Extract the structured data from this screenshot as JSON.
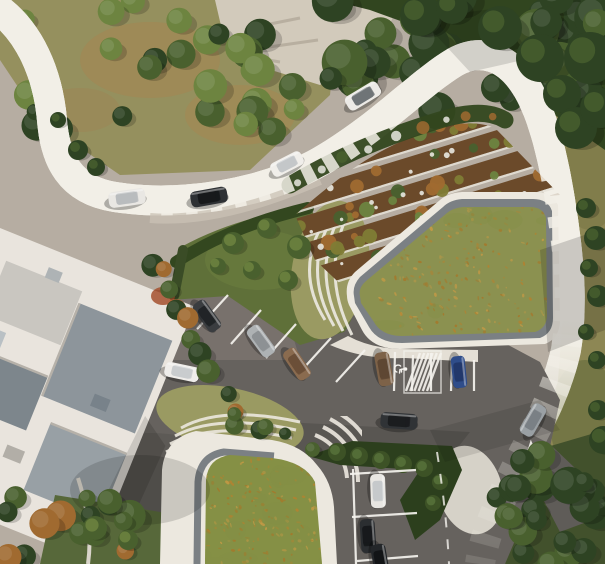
{
  "scene": {
    "description": "Aerial architectural rendering: two green-roof buildings with planted terraces, curving access road with cars, central parking lot",
    "palette": {
      "base": "#b6ada2",
      "road_light": "#a9a199",
      "road_mid": "#978f88",
      "road_dark": "#6b6864",
      "road_edge": "#f2efe7",
      "asphalt": "#66625e",
      "asphalt_light": "#8d867f",
      "asphalt_shadow": "#55524e",
      "line_white": "#f5f3ee",
      "veg_ground": "#95905e",
      "dirt_patch": "#a8844f",
      "rock": "#d2cabb",
      "grass_right": "#8d8754",
      "lawn": "#5f7039",
      "lawn_dark": "#4c5c2f",
      "tree_dark": "#2e4323",
      "tree_mid": "#49602e",
      "tree_light": "#6d8440",
      "tree_olive": "#7f7c35",
      "tree_orange": "#a06a30",
      "roof_green": "#8b9150",
      "roof_green2": "#859045",
      "speckle1": "#b5812f",
      "speckle2": "#c79a45",
      "speckle3": "#a87628",
      "gravel": "#7b8084",
      "rim": "#ece8df",
      "rim_shadow": "#cfc9bd",
      "slab_bed": "#9a9a62",
      "bldg_white": "#e9e4dd",
      "bldg_shade": "#d8d2c8",
      "slate": "#8d959b",
      "slate_dark": "#6d767b",
      "soil": "#6b4a2a",
      "blossom": "#e9e8e0",
      "hedge": "#33471f",
      "paving": "#d6d2c8"
    },
    "cars": [
      {
        "name": "car-road-white-1",
        "x": 127,
        "y": 198,
        "a": -8,
        "len": 37,
        "wid": 16,
        "body": "#e9e7e3",
        "roof": "#b9bcbe"
      },
      {
        "name": "car-road-dark",
        "x": 209,
        "y": 197,
        "a": -10,
        "len": 37,
        "wid": 16,
        "body": "#2e3134",
        "roof": "#17191b"
      },
      {
        "name": "car-road-white-2",
        "x": 287,
        "y": 164,
        "a": -27,
        "len": 34,
        "wid": 15,
        "body": "#f0eeea",
        "roof": "#c4c7c9"
      },
      {
        "name": "car-road-white-3",
        "x": 363,
        "y": 96,
        "a": -31,
        "len": 37,
        "wid": 16,
        "body": "#eceae6",
        "roof": "#6f7477"
      },
      {
        "name": "car-parked-dark-1",
        "x": 207,
        "y": 316,
        "a": 54,
        "len": 34,
        "wid": 15,
        "body": "#3a3d40",
        "roof": "#212427"
      },
      {
        "name": "car-parked-silver",
        "x": 261,
        "y": 341,
        "a": 54,
        "len": 34,
        "wid": 15,
        "body": "#aeb2b4",
        "roof": "#8d9194"
      },
      {
        "name": "car-parked-brown-1",
        "x": 297,
        "y": 364,
        "a": 56,
        "len": 34,
        "wid": 15,
        "body": "#8a6b4f",
        "roof": "#6b4f38"
      },
      {
        "name": "car-parked-brown-2",
        "x": 384,
        "y": 369,
        "a": 80,
        "len": 34,
        "wid": 15,
        "body": "#7d6248",
        "roof": "#5e4733"
      },
      {
        "name": "car-parked-blue",
        "x": 459,
        "y": 372,
        "a": 84,
        "len": 32,
        "wid": 14,
        "body": "#2f4d8a",
        "roof": "#22386b"
      },
      {
        "name": "car-lot-white-moving",
        "x": 182,
        "y": 372,
        "a": 12,
        "len": 35,
        "wid": 15,
        "body": "#efedea",
        "roof": "#c9ccce"
      },
      {
        "name": "car-suv-dark",
        "x": 399,
        "y": 421,
        "a": 4,
        "len": 37,
        "wid": 16,
        "body": "#303336",
        "roof": "#1b1d1f"
      },
      {
        "name": "car-road-silver",
        "x": 533,
        "y": 420,
        "a": -60,
        "len": 34,
        "wid": 15,
        "body": "#9aa0a4",
        "roof": "#7a8085"
      },
      {
        "name": "car-parked-white-lower",
        "x": 378,
        "y": 491,
        "a": 88,
        "len": 34,
        "wid": 15,
        "body": "#e8e6e2",
        "roof": "#c6c9cb"
      },
      {
        "name": "car-parked-dark-lower-1",
        "x": 368,
        "y": 536,
        "a": 86,
        "len": 34,
        "wid": 15,
        "body": "#2b2e31",
        "roof": "#17191c"
      },
      {
        "name": "car-parked-dark-lower-2",
        "x": 380,
        "y": 560,
        "a": 80,
        "len": 32,
        "wid": 15,
        "body": "#232629",
        "roof": "#121416"
      }
    ],
    "stall_lines": [
      [
        197,
        329,
        228,
        295
      ],
      [
        231,
        344,
        261,
        310
      ],
      [
        266,
        358,
        296,
        324
      ],
      [
        301,
        371,
        331,
        338
      ],
      [
        336,
        382,
        365,
        350
      ],
      [
        394,
        391,
        395,
        352
      ],
      [
        412,
        391,
        413,
        355
      ],
      [
        431,
        391,
        431,
        353
      ],
      [
        451,
        391,
        452,
        356
      ],
      [
        474,
        391,
        474,
        360
      ],
      [
        350,
        474,
        416,
        470
      ],
      [
        352,
        517,
        417,
        513
      ],
      [
        357,
        561,
        418,
        556
      ],
      [
        353,
        469,
        356,
        564
      ]
    ],
    "hatch_zone": {
      "x": 412,
      "y": 353,
      "w": 21,
      "h": 38,
      "n": 6
    },
    "handicap_mark": {
      "x": 401,
      "y": 369
    },
    "traffic_island": {
      "points": "513,502 531,444 551,492"
    },
    "road_dashes": {
      "pattern": "11 13",
      "width": 2
    },
    "speckle_fields": [
      {
        "clip": "clipRoofU",
        "x": 355,
        "y": 200,
        "w": 200,
        "h": 140,
        "n": 300,
        "seed": 7
      },
      {
        "clip": "clipRoofL",
        "x": 200,
        "y": 448,
        "w": 135,
        "h": 118,
        "n": 230,
        "seed": 11
      }
    ],
    "terraces": {
      "rows": 5,
      "row_h": 26,
      "angle": -17,
      "seed": 5
    },
    "tree_clusters": [
      {
        "layer": "trees-back",
        "type": "box",
        "x": 330,
        "y": -10,
        "w": 275,
        "h": 130,
        "n": 34,
        "rmin": 11,
        "rmax": 24,
        "seed": 21,
        "palette": [
          "tree_dark",
          "tree_mid",
          "tree_dark"
        ]
      },
      {
        "layer": "trees-back",
        "type": "box",
        "x": 15,
        "y": -5,
        "w": 290,
        "h": 140,
        "n": 30,
        "rmin": 8,
        "rmax": 17,
        "seed": 31,
        "palette": [
          "tree_mid",
          "tree_light",
          "tree_dark",
          "tree_light"
        ]
      },
      {
        "layer": "trees-front",
        "type": "box",
        "x": 520,
        "y": 455,
        "w": 90,
        "h": 115,
        "n": 18,
        "rmin": 9,
        "rmax": 20,
        "seed": 41,
        "palette": [
          "tree_dark",
          "tree_mid",
          "tree_dark"
        ]
      },
      {
        "layer": "trees-front",
        "type": "box",
        "x": -5,
        "y": 492,
        "w": 140,
        "h": 75,
        "n": 15,
        "rmin": 8,
        "rmax": 16,
        "seed": 51,
        "palette": [
          "tree_mid",
          "tree_dark",
          "tree_orange",
          "tree_mid"
        ]
      },
      {
        "layer": "trees-front",
        "type": "line",
        "x1": 152,
        "y1": 262,
        "x2": 240,
        "y2": 420,
        "n": 12,
        "rmin": 7,
        "rmax": 12,
        "seed": 61,
        "palette": [
          "tree_dark",
          "tree_orange",
          "tree_mid"
        ]
      },
      {
        "layer": "trees-front",
        "type": "line",
        "x1": 240,
        "y1": 422,
        "x2": 305,
        "y2": 448,
        "n": 5,
        "rmin": 6,
        "rmax": 10,
        "seed": 66,
        "palette": [
          "tree_mid",
          "tree_dark"
        ]
      },
      {
        "layer": "trees-front",
        "type": "box",
        "x": 488,
        "y": 450,
        "w": 45,
        "h": 70,
        "n": 7,
        "rmin": 8,
        "rmax": 15,
        "seed": 71,
        "palette": [
          "tree_dark",
          "tree_mid"
        ]
      }
    ],
    "tree_circles": [
      [
        420,
        16,
        20
      ],
      [
        452,
        8,
        16
      ],
      [
        500,
        28,
        22
      ],
      [
        540,
        58,
        24
      ],
      [
        562,
        94,
        19
      ],
      [
        576,
        128,
        21
      ],
      [
        590,
        58,
        26
      ],
      [
        600,
        108,
        20
      ],
      [
        586,
        208,
        10
      ],
      [
        596,
        238,
        12
      ],
      [
        589,
        268,
        9
      ],
      [
        598,
        296,
        11
      ],
      [
        586,
        332,
        8
      ],
      [
        597,
        360,
        9
      ],
      [
        78,
        150,
        10
      ],
      [
        96,
        167,
        9
      ],
      [
        58,
        120,
        8
      ],
      [
        603,
        440,
        14
      ],
      [
        598,
        410,
        10
      ]
    ],
    "lawn_trees": [
      [
        233,
        243,
        11
      ],
      [
        267,
        228,
        10
      ],
      [
        299,
        247,
        12
      ],
      [
        252,
        270,
        9
      ],
      [
        218,
        266,
        8
      ],
      [
        288,
        280,
        10
      ],
      [
        95,
        528,
        12
      ],
      [
        128,
        540,
        10
      ]
    ],
    "bushes": [
      [
        337,
        452,
        9
      ],
      [
        359,
        456,
        9
      ],
      [
        381,
        460,
        9
      ],
      [
        403,
        464,
        9
      ],
      [
        424,
        468,
        9
      ],
      [
        440,
        482,
        8
      ],
      [
        433,
        503,
        8
      ]
    ]
  }
}
